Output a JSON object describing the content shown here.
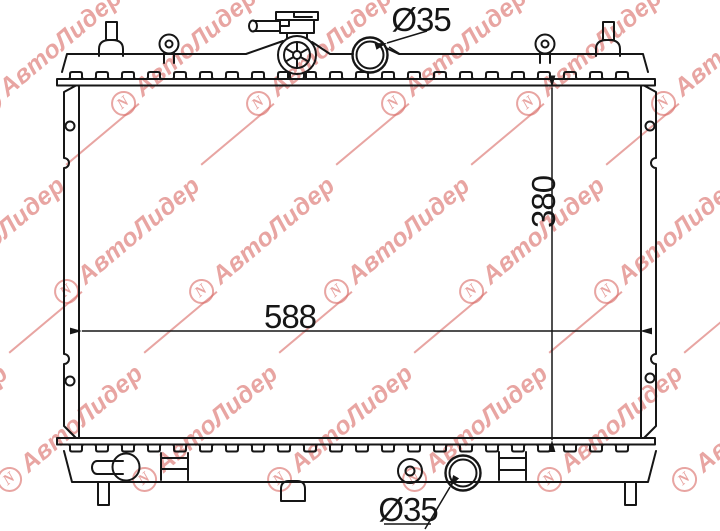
{
  "drawing": {
    "part": "radiator-schematic",
    "labels": {
      "core_width": "588",
      "core_height": "380",
      "inlet_diameter": "Ø35",
      "outlet_diameter": "Ø35"
    },
    "colors": {
      "line": "#161616",
      "background": "#ffffff"
    }
  },
  "watermark": {
    "text": "АвтоЛидер",
    "logo_letter": "N",
    "color": "#d96a66"
  }
}
